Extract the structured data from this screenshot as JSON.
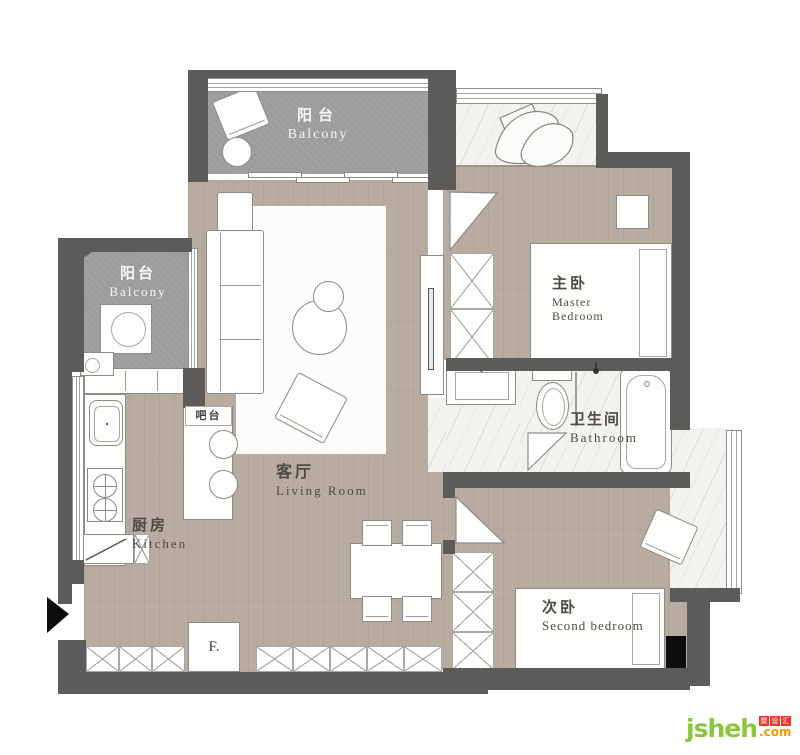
{
  "rooms": {
    "balcony_top": {
      "zh": "阳台",
      "en": "Balcony"
    },
    "balcony_left": {
      "zh": "阳台",
      "en": "Balcony"
    },
    "living": {
      "zh": "客厅",
      "en": "Living Room"
    },
    "kitchen": {
      "zh": "厨房",
      "en": "Kitchen"
    },
    "master": {
      "zh": "主卧",
      "en1": "Master",
      "en2": "Bedroom"
    },
    "bathroom": {
      "zh": "卫生间",
      "en": "Bathroom"
    },
    "second": {
      "zh": "次卧",
      "en": "Second bedroom"
    }
  },
  "labels": {
    "bar": "吧台",
    "fridge": "F."
  },
  "watermark": {
    "name": "jsheh",
    "cn_chars": [
      "聚",
      "设",
      "汇"
    ],
    "tld": ".com"
  },
  "colors": {
    "wall": "#5c5b59",
    "wood_floor": "#b7ac9f",
    "balcony_floor": "#9d9c9a",
    "marble_floor": "#f3f2ee",
    "rug": "#fcfcfa",
    "outline": "#8b8b88",
    "accent_black": "#0d0d0d",
    "logo_green": "#8cc63f",
    "logo_red": "#e8382f",
    "logo_orange": "#f39800",
    "label_dark": "#4e4b46",
    "label_light": "#f6f6f4"
  }
}
